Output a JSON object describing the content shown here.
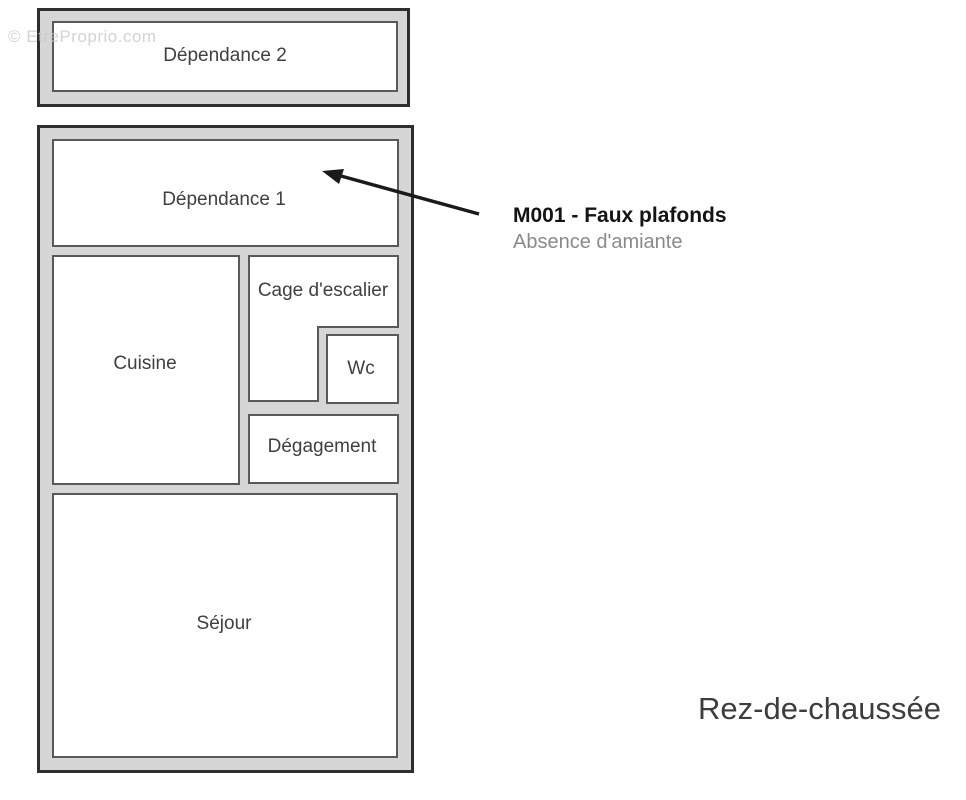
{
  "watermark": "© EtreProprio.com",
  "floor_title": "Rez-de-chaussée",
  "annotation": {
    "title": "M001 - Faux plafonds",
    "detail": "Absence d'amiante"
  },
  "rooms": {
    "dependance2": "Dépendance 2",
    "dependance1": "Dépendance 1",
    "cuisine": "Cuisine",
    "cage_escalier": "Cage d'escalier",
    "wc": "Wc",
    "degagement": "Dégagement",
    "sejour": "Séjour"
  },
  "colors": {
    "page-bg": "#ffffff",
    "outer-fill": "#d6d6d6",
    "outer-border": "#2e2e2e",
    "room-fill": "#ffffff",
    "room-border": "#595959",
    "label-color": "#3f3f3f",
    "arrow-color": "#1a1a1a",
    "annotation-title-color": "#141414",
    "annotation-detail-color": "#8a8a8a",
    "floor-title-color": "#3d3d3d",
    "watermark-color": "#c9c9c9"
  }
}
